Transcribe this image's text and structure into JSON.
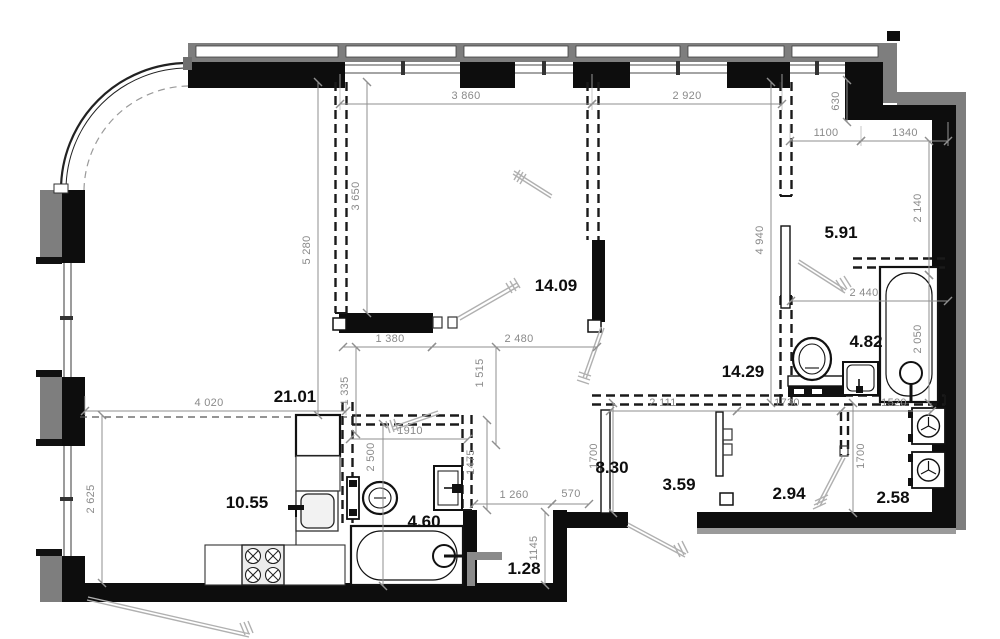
{
  "rooms": {
    "living": "21.01",
    "kitchen": "10.55",
    "bedroom": "14.09",
    "hallway": "5.91",
    "bathroom_main": "4.82",
    "corridor": "14.29",
    "hall": "8.30",
    "bathroom_small": "4.60",
    "niche": "1.28",
    "storage": "3.59",
    "wardrobe": "2.94",
    "laundry": "2.58"
  },
  "dims": {
    "d3860": "3 860",
    "d2920": "2 920",
    "d630": "630",
    "d1100": "1100",
    "d1340": "1340",
    "d2140": "2 140",
    "d2050": "2 050",
    "d2440": "2 440",
    "d4940": "4 940",
    "d5280": "5 280",
    "d3650": "3 650",
    "d1380": "1 380",
    "d2480": "2 480",
    "d1335": "1 335",
    "d1515": "1 515",
    "d4020": "4 020",
    "d2625": "2 625",
    "d1910": "1910",
    "d2500": "2 500",
    "d1475": "1475",
    "d1260": "1 260",
    "d570": "570",
    "d1145": "1145",
    "d2111": "2 111",
    "d1730": "1730",
    "d1520": "1520",
    "d1700": "1700"
  },
  "colors": {
    "wall": "#0d0d0d",
    "exterior_band": "#7e7e7e",
    "dimension": "#8a8a8a",
    "label": "#0e0e0e",
    "door_swing": "#b0b0b0"
  },
  "fixtures": [
    "toilet",
    "washbasin",
    "bathtub",
    "toilet",
    "washbasin",
    "bathtub",
    "stove",
    "kitchen-sink",
    "fridge",
    "washing-machine",
    "washing-machine"
  ]
}
